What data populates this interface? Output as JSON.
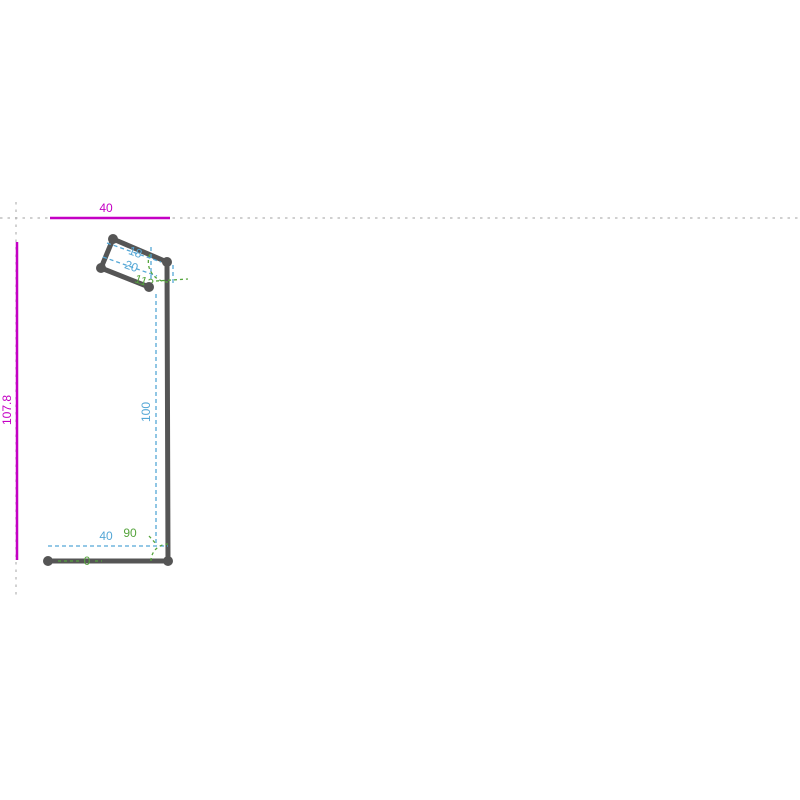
{
  "colors": {
    "magenta": "#c400c4",
    "blue": "#54a7d6",
    "green": "#55a43c",
    "profile": "#555555",
    "construction": "#b3b3b3"
  },
  "labels": {
    "overall_width": "40",
    "overall_height": "107.8",
    "seg_hem_end": "18",
    "seg_hem_top": "20",
    "seg_web": "100",
    "seg_flange": "40",
    "angle_top_bend": "113",
    "angle_bottom_bend": "90",
    "angle_flange": "0"
  }
}
